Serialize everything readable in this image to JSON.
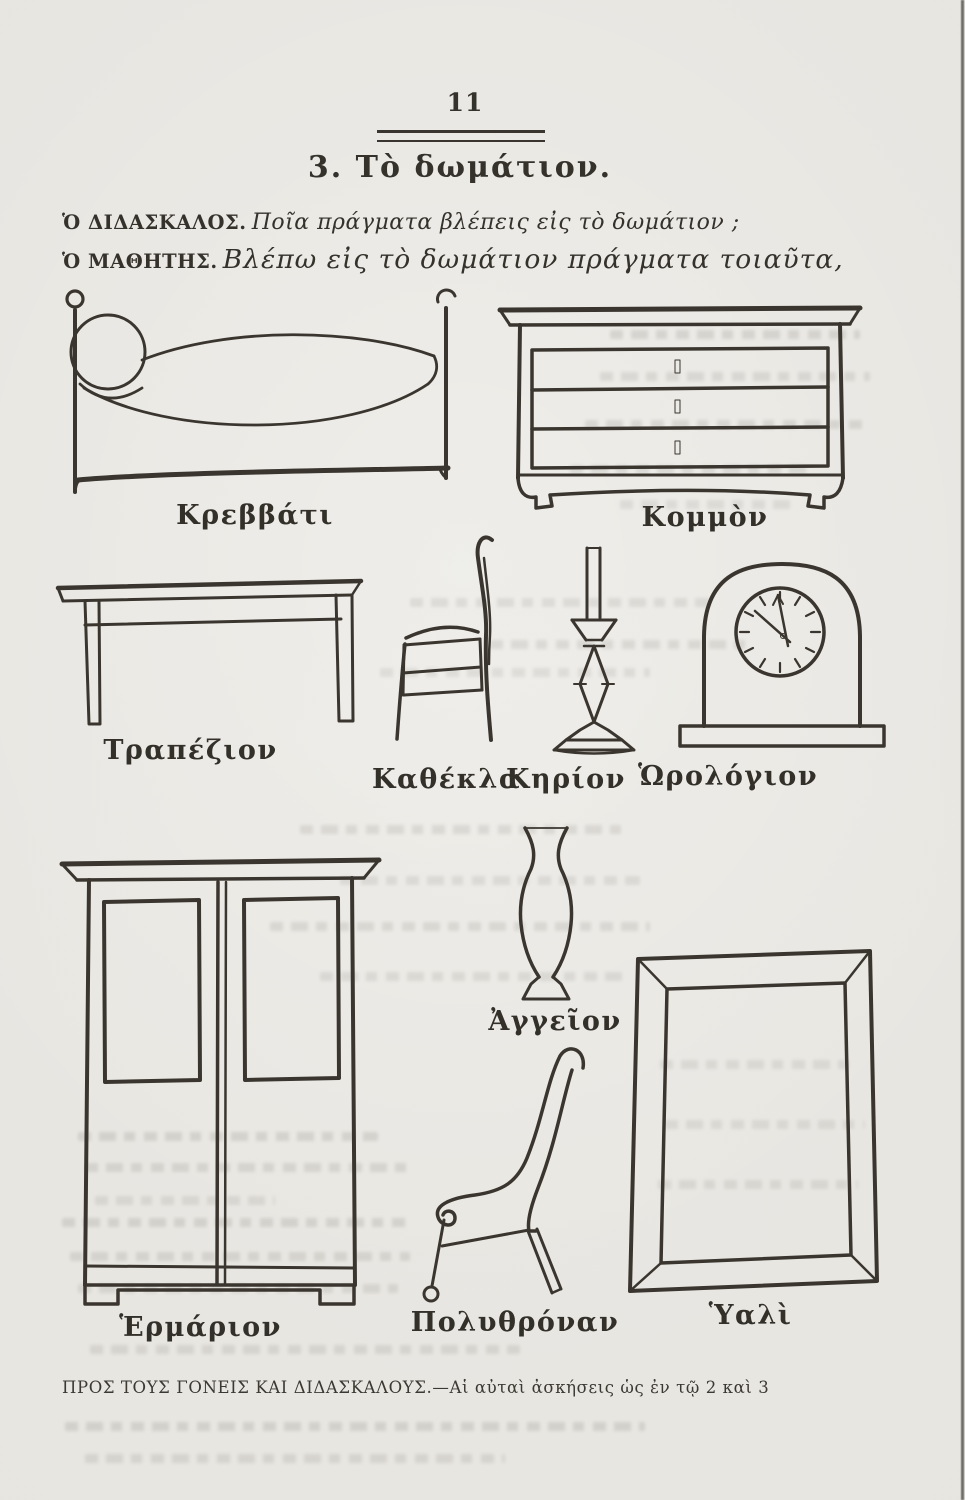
{
  "page": {
    "number": "11",
    "section_title": "3. Τὸ δωμάτιον.",
    "dialog": [
      {
        "speaker": "Ὁ ΔΙΔΑΣΚΑΛΟΣ.",
        "text": "Ποῖα πράγματα βλέπεις εἰς τὸ δωμάτιον ;"
      },
      {
        "speaker": "Ὁ ΜΑΘΗΤΗΣ.",
        "text": "Βλέπω εἰς τὸ δωμάτιον πράγματα τοιαῦτα,"
      }
    ],
    "figures": [
      {
        "item": "bed",
        "label": "Κρεββάτι"
      },
      {
        "item": "commode",
        "label": "Κομμὸν"
      },
      {
        "item": "table",
        "label": "Τραπέζιον"
      },
      {
        "item": "chair",
        "label": "Καθέκλα"
      },
      {
        "item": "candle",
        "label": "Κηρίον"
      },
      {
        "item": "clock",
        "label": "Ὡρολόγιον"
      },
      {
        "item": "vase",
        "label": "Ἀγγεῖον"
      },
      {
        "item": "wardrobe",
        "label": "Ἑρμάριον"
      },
      {
        "item": "armchair",
        "label": "Πολυθρόναν"
      },
      {
        "item": "mirror",
        "label": "Ὑαλὶ"
      }
    ],
    "footer_note": "ΠΡΟΣ ΤΟΥΣ ΓΟΝΕΙΣ ΚΑΙ ΔΙΔΑΣΚΑΛΟΥΣ.—Αἱ αὐταὶ ἀσκήσεις ὡς ἐν τῷ 2 καὶ 3",
    "colors": {
      "paper": "#e7e5e0",
      "ink": "#35322c"
    }
  }
}
